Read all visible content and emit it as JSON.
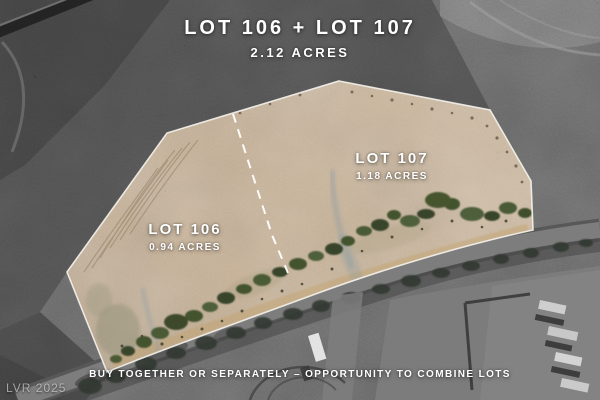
{
  "header": {
    "title": "LOT 106 + LOT 107",
    "subtitle": "2.12 ACRES"
  },
  "lots": [
    {
      "name": "LOT 106",
      "acreage": "0.94 ACRES"
    },
    {
      "name": "LOT 107",
      "acreage": "1.18 ACRES"
    }
  ],
  "footer": {
    "tagline": "BUY TOGETHER OR SEPARATELY – OPPORTUNITY TO COMBINE LOTS"
  },
  "watermark": {
    "text": "LVR 2025"
  },
  "map": {
    "divider_style": "dashed",
    "colors": {
      "lot_fill": "#c9b193",
      "lot_border": "#f5f2ec",
      "divider": "#ffffff",
      "road": "#7d7d7d",
      "terrain_dark": "#4f4f4f",
      "text": "#ffffff"
    }
  }
}
